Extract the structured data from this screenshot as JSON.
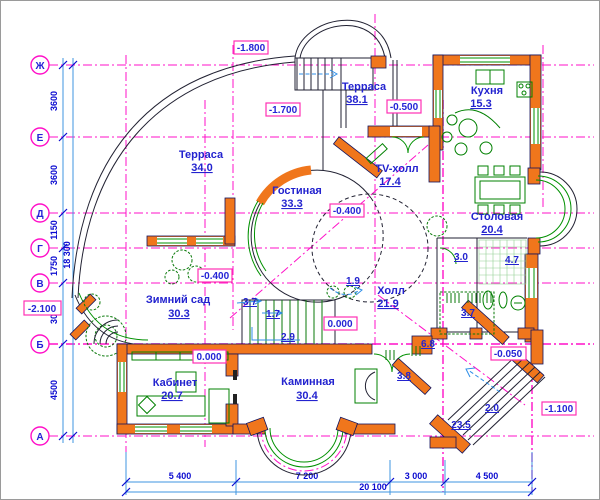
{
  "title": "floor-plan",
  "axes": {
    "rows": [
      {
        "label": "Ж"
      },
      {
        "label": "Е"
      },
      {
        "label": "Д"
      },
      {
        "label": "Г"
      },
      {
        "label": "В"
      },
      {
        "label": "Б"
      },
      {
        "label": "А"
      }
    ]
  },
  "left_dims": {
    "seg1": "3600",
    "seg2": "3600",
    "seg3": "1150",
    "seg4": "1750",
    "seg5": "3000",
    "seg6": "4500",
    "total": "18 300"
  },
  "bottom_dims": {
    "seg1": "5 400",
    "seg2": "7 200",
    "seg3": "3 000",
    "seg4": "4 500",
    "total": "20 100"
  },
  "rooms": [
    {
      "name": "Терраса",
      "area": "38.1"
    },
    {
      "name": "Кухня",
      "area": "15.3"
    },
    {
      "name": "Терраса",
      "area": "34.0"
    },
    {
      "name": "Гостиная",
      "area": "33.3"
    },
    {
      "name": "TV-холл",
      "area": "17.4"
    },
    {
      "name": "Столовая",
      "area": "20.4"
    },
    {
      "name": "Зимний сад",
      "area": "30.3"
    },
    {
      "name": "Холл",
      "area": "21.9"
    },
    {
      "name": "Кабинет",
      "area": "20.7"
    },
    {
      "name": "Каминная",
      "area": "30.4"
    }
  ],
  "elevations": [
    {
      "value": "-1.800"
    },
    {
      "value": "-1.700"
    },
    {
      "value": "-0.500"
    },
    {
      "value": "-0.400"
    },
    {
      "value": "-0.400"
    },
    {
      "value": "-2.100"
    },
    {
      "value": "0.000"
    },
    {
      "value": "0.000"
    },
    {
      "value": "-0.050"
    },
    {
      "value": "-1.100"
    }
  ],
  "small_areas": [
    {
      "value": "3.7"
    },
    {
      "value": "1.7"
    },
    {
      "value": "2.9"
    },
    {
      "value": "1.9"
    },
    {
      "value": "3.0"
    },
    {
      "value": "4.7"
    },
    {
      "value": "3.7"
    },
    {
      "value": "6.8"
    },
    {
      "value": "3.8"
    },
    {
      "value": "2.0"
    },
    {
      "value": "23.5"
    }
  ],
  "colors": {
    "grid_magenta": "#ff10c8",
    "wall_orange": "#f0761c",
    "furniture_green": "#008000",
    "text_blue": "#2323cf",
    "dim_blue": "#3f95e0"
  }
}
